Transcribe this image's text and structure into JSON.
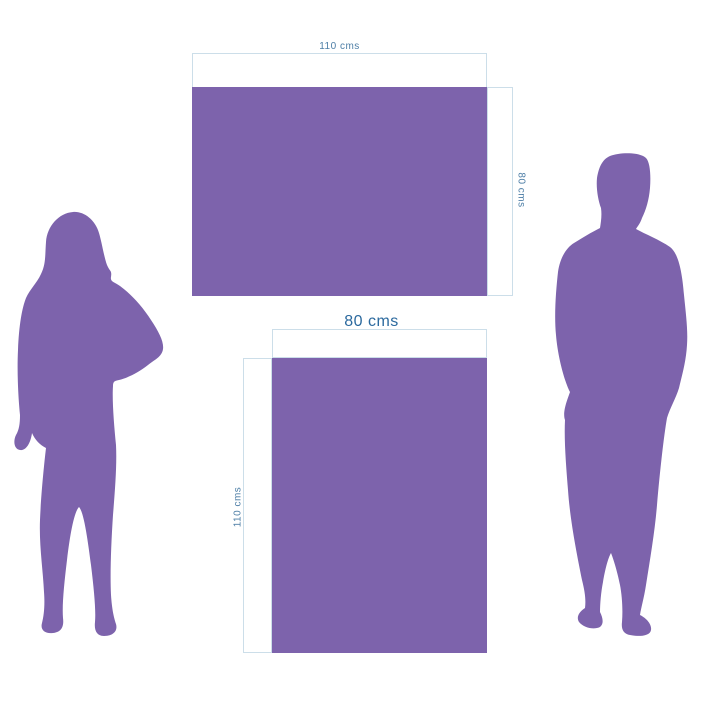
{
  "page": {
    "background": "#ffffff",
    "description": "Size comparison diagram with two purple rectangles and man / woman silhouettes"
  },
  "colors": {
    "purple": "#7D63AC",
    "dimension_line": "#CCDEE9",
    "label_small": "#4D7EA6",
    "label_large": "#2B699E",
    "background": "#ffffff"
  },
  "diagram": {
    "type": "size-comparison",
    "rect_landscape": {
      "width_label": "110 cms",
      "height_label": "80 cms"
    },
    "rect_portrait": {
      "width_label": "80 cms",
      "height_label": "110 cms"
    },
    "figures": [
      {
        "name": "woman-silhouette"
      },
      {
        "name": "man-silhouette"
      }
    ]
  }
}
